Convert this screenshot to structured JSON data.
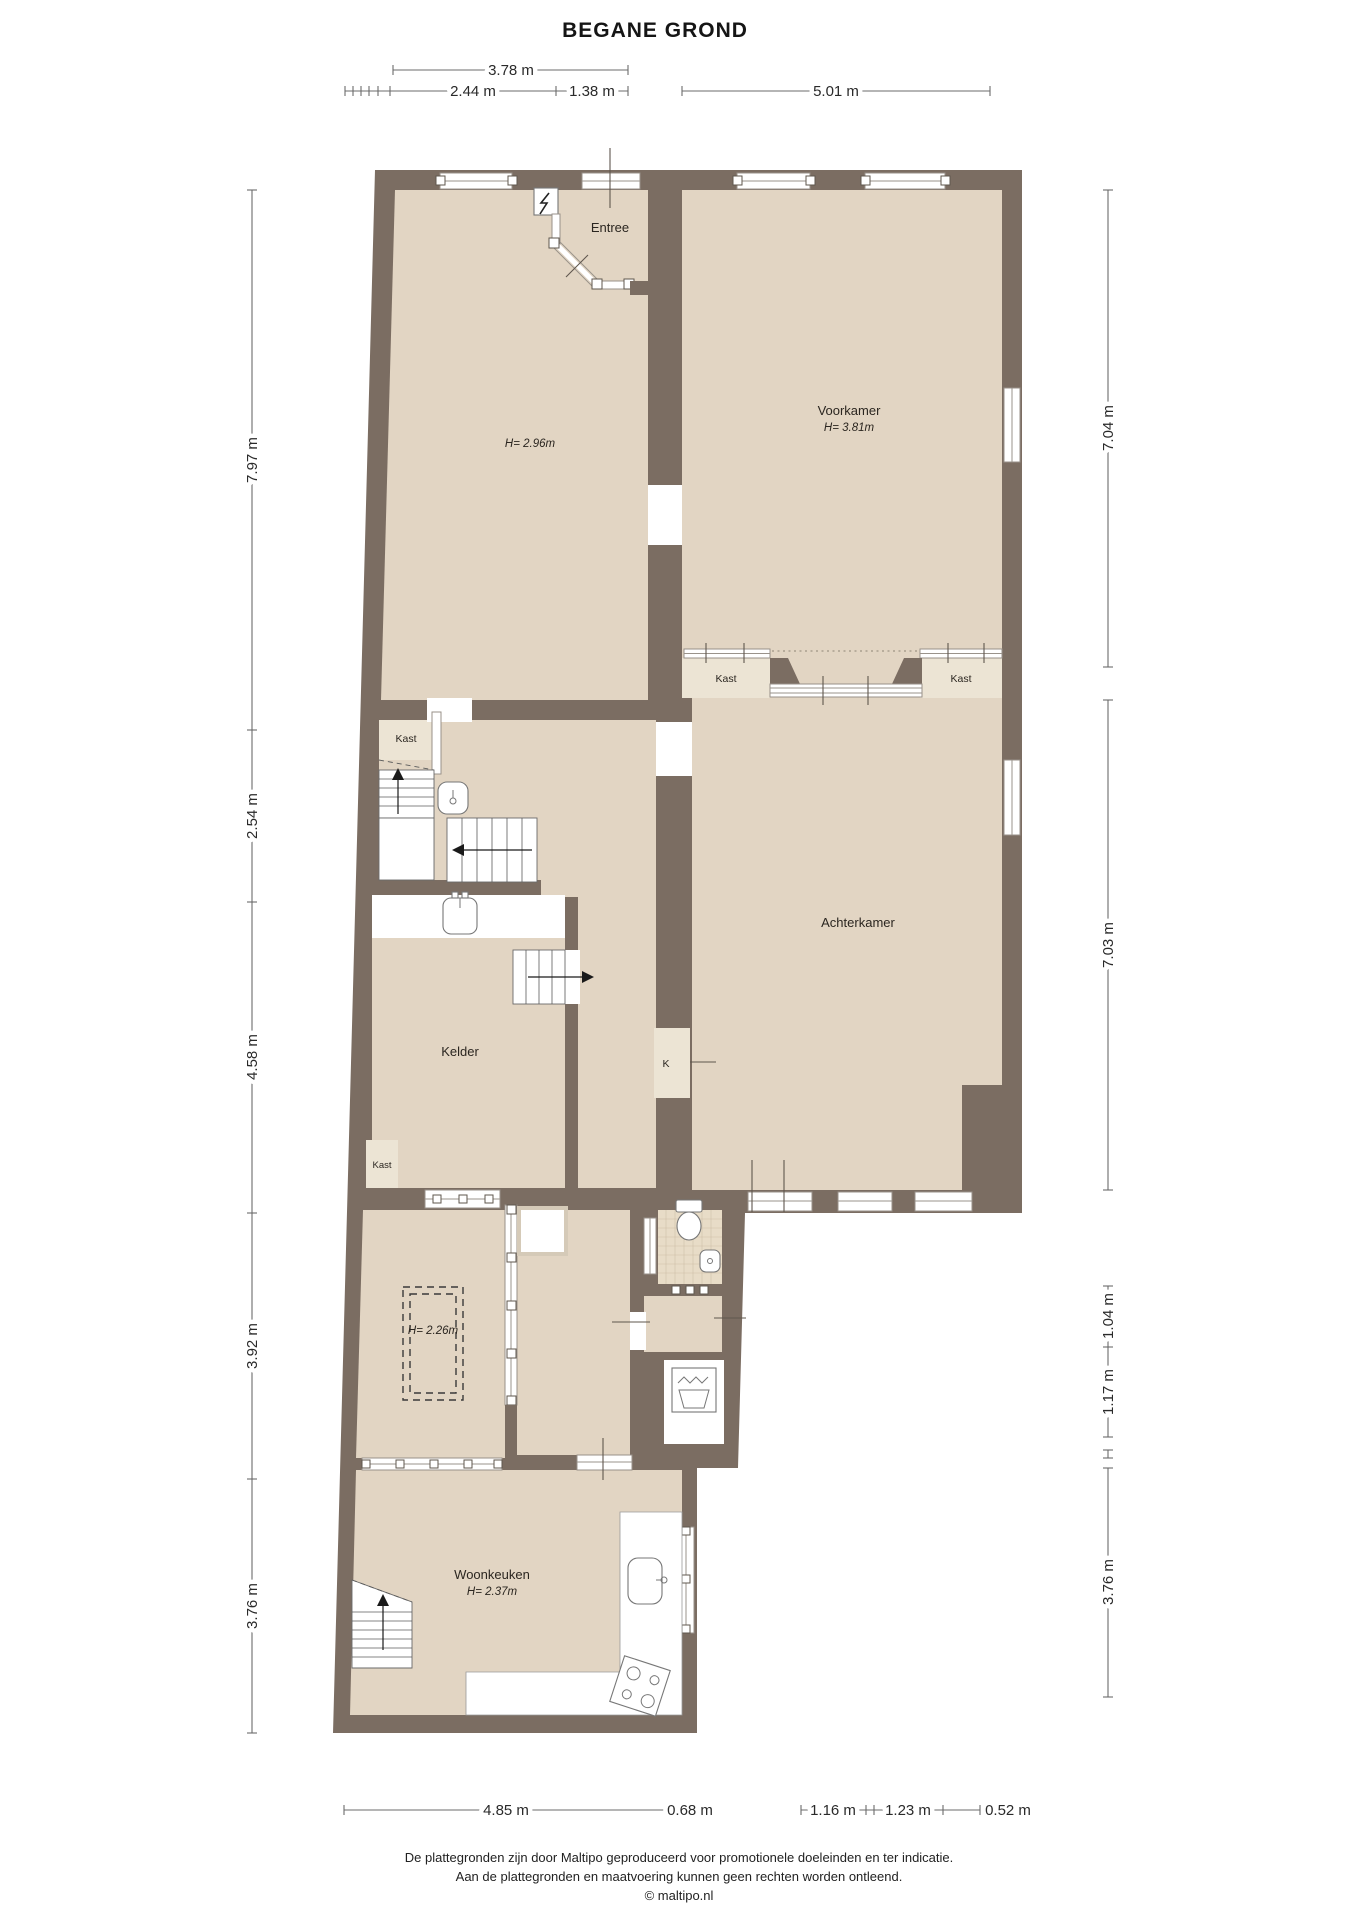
{
  "title": "BEGANE GROND",
  "rooms": {
    "entree": {
      "label": "Entree"
    },
    "voorkamer": {
      "label": "Voorkamer",
      "height": "H= 3.81m"
    },
    "front_room": {
      "height": "H= 2.96m"
    },
    "achterkamer": {
      "label": "Achterkamer"
    },
    "kelder": {
      "label": "Kelder"
    },
    "back_room": {
      "height": "H= 2.26m"
    },
    "woonkeuken": {
      "label": "Woonkeuken",
      "height": "H= 2.37m"
    },
    "closet_hall": {
      "label": "Kast"
    },
    "closet_kelder": {
      "label": "Kast"
    },
    "closet_ensuite_left": {
      "label": "Kast"
    },
    "closet_ensuite_right": {
      "label": "Kast"
    },
    "closet_k": {
      "label": "K"
    }
  },
  "dimensions": {
    "top_total": "3.78 m",
    "top": [
      "2.44 m",
      "1.38 m",
      "5.01 m"
    ],
    "left": [
      "7.97 m",
      "2.54 m",
      "4.58 m",
      "3.92 m",
      "3.76 m"
    ],
    "right": [
      "7.04 m",
      "7.03 m",
      "1.04 m",
      "1.17 m",
      "3.76 m"
    ],
    "bottom": [
      "4.85 m",
      "0.68 m",
      "1.16 m",
      "1.23 m",
      "0.52 m"
    ]
  },
  "footer": {
    "line1": "De plattegronden zijn door Maltipo geproduceerd voor promotionele doeleinden en ter indicatie.",
    "line2": "Aan de plattegronden en maatvoering kunnen geen rechten worden ontleend.",
    "line3": "© maltipo.nl"
  },
  "colors": {
    "wall": "#7b6d62",
    "floor": "#e2d5c3",
    "closet": "#ece4d4",
    "tile": "#e8dcc7",
    "dim_line": "#6b6b6b",
    "text": "#2a2a2a"
  }
}
